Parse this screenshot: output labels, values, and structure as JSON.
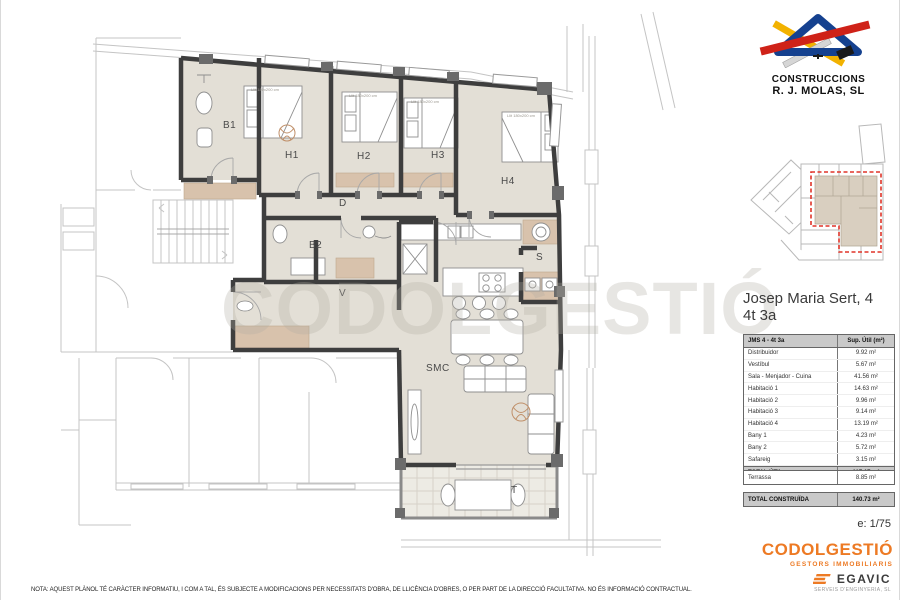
{
  "builder": {
    "line1": "CONSTRUCCIONS",
    "line2": "R. J. MOLAS, SL"
  },
  "title": {
    "line1": "Josep Maria Sert, 4",
    "line2": "4t 3a"
  },
  "plan": {
    "rooms": {
      "b1": "B1",
      "h1": "H1",
      "h2": "H2",
      "h3": "H3",
      "h4": "H4",
      "d": "D",
      "b2": "B2",
      "v": "V",
      "s": "S",
      "smc": "SMC",
      "t": "T"
    },
    "bed_label": "Llit 180x200 cm",
    "watermark": "CODOLGESTIÓ"
  },
  "table": {
    "header": {
      "label": "JMS 4 - 4t 3a",
      "value": "Sup. Útil (m²)"
    },
    "rows": [
      {
        "label": "Distribuidor",
        "value": "9.92 m²"
      },
      {
        "label": "Vestíbul",
        "value": "5.67 m²"
      },
      {
        "label": "Sala - Menjador - Cuina",
        "value": "41.56 m²"
      },
      {
        "label": "Habitació 1",
        "value": "14.63 m²"
      },
      {
        "label": "Habitació 2",
        "value": "9.96 m²"
      },
      {
        "label": "Habitació 3",
        "value": "9.14 m²"
      },
      {
        "label": "Habitació 4",
        "value": "13.19 m²"
      },
      {
        "label": "Bany 1",
        "value": "4.23 m²"
      },
      {
        "label": "Bany 2",
        "value": "5.72 m²"
      },
      {
        "label": "Safareig",
        "value": "3.15 m²"
      }
    ],
    "total_util": {
      "label": "TOTAL ÚTIL",
      "value": "117.17 m²"
    },
    "terrassa": {
      "label": "Terrassa",
      "value": "8.85 m²"
    },
    "total_const": {
      "label": "TOTAL CONSTRUÏDA",
      "value": "140.73 m²"
    }
  },
  "scale": "e: 1/75",
  "brands": {
    "codolgestio": {
      "name": "CODOLGESTIÓ",
      "tagline": "GESTORS IMMOBILIARIS",
      "color": "#ED7A24"
    },
    "egavic": {
      "name": "EGAVIC",
      "tagline": "SERVEIS D'ENGINYERIA, SL"
    }
  },
  "note": "NOTA: AQUEST PLÀNOL TÉ CARÀCTER INFORMATIU, I COM A TAL, ÉS SUBJECTE A MODIFICACIONS PER NECESSITATS D'OBRA, DE LLICÈNCIA D'OBRES, O PER PART DE LA DIRECCIÓ FACULTATIVA. NO ÉS INFORMACIÓ CONTRACTUAL.",
  "colors": {
    "accent_orange": "#ED7A24",
    "highlight_red": "#E03428",
    "floor_beige": "#E3DFD6",
    "furniture_tan": "#D8C2AC",
    "wall_dark": "#3E3E3E",
    "table_gray": "#C9C9C9"
  }
}
